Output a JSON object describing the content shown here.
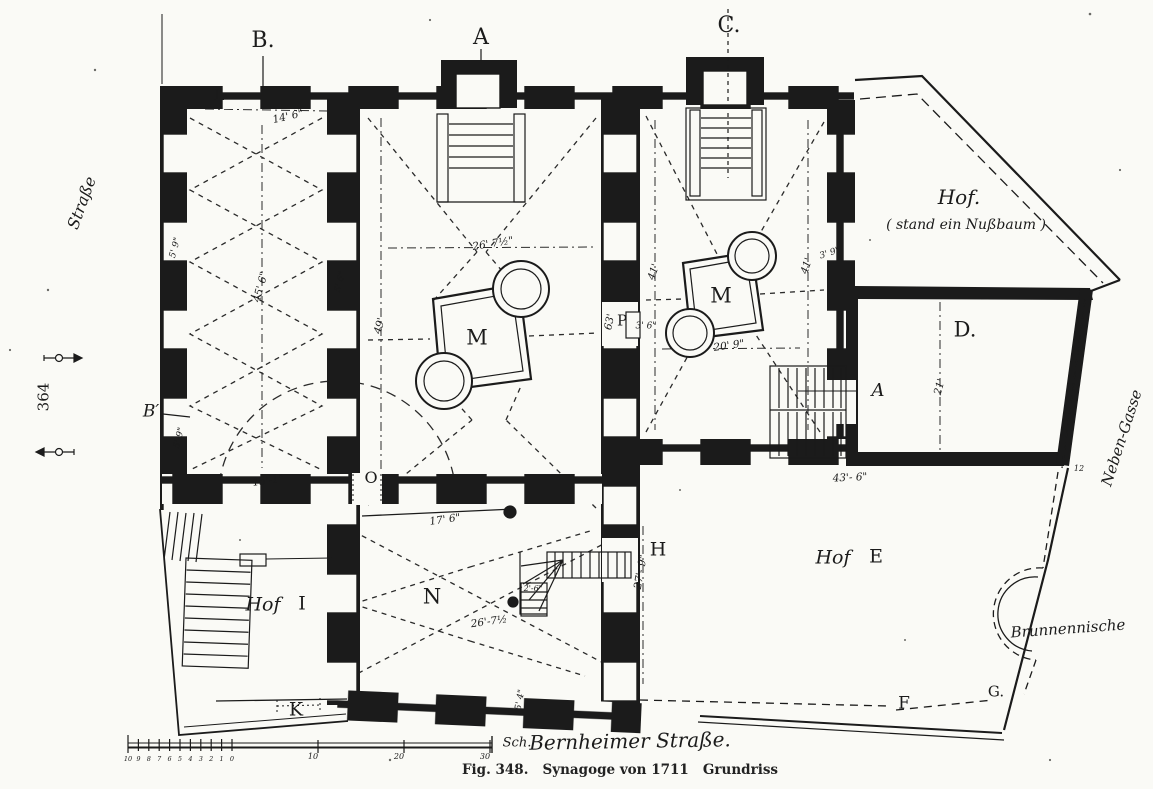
{
  "figure": {
    "caption": "Fig. 348.   Synagoge von 1711   Grundriss"
  },
  "colors": {
    "ink": "#1b1b1b",
    "paper": "#fafaf6"
  },
  "scale_bar": {
    "fine_tick_labels": [
      "10",
      "9",
      "8",
      "7",
      "6",
      "5",
      "4",
      "3",
      "2",
      "1",
      "0"
    ],
    "major_tick_labels": [
      "10",
      "20",
      "30"
    ],
    "unit_label": "Sch."
  },
  "labels": [
    {
      "id": "section-b",
      "t": "B.",
      "x": 263,
      "y": 41,
      "s": 22,
      "c": "letter"
    },
    {
      "id": "section-a",
      "t": "A",
      "x": 481,
      "y": 38,
      "s": 22,
      "c": "letter"
    },
    {
      "id": "section-c",
      "t": "C.",
      "x": 729,
      "y": 26,
      "s": 22,
      "c": "letter"
    },
    {
      "id": "room-l",
      "t": "L",
      "x": 219,
      "y": 95,
      "s": 16,
      "c": "letter"
    },
    {
      "id": "door-o",
      "t": "O",
      "x": 371,
      "y": 478,
      "s": 16,
      "c": "letter"
    },
    {
      "id": "room-n",
      "t": "N",
      "x": 432,
      "y": 597,
      "s": 21,
      "c": "letter"
    },
    {
      "id": "bimah-m-main",
      "t": "M",
      "x": 477,
      "y": 338,
      "s": 21,
      "c": "letter"
    },
    {
      "id": "bimah-m-right",
      "t": "M",
      "x": 721,
      "y": 296,
      "s": 21,
      "c": "letter"
    },
    {
      "id": "room-d",
      "t": "D.",
      "x": 965,
      "y": 330,
      "s": 21,
      "c": "letter"
    },
    {
      "id": "door-h",
      "t": "H",
      "x": 658,
      "y": 550,
      "s": 19,
      "c": "letter"
    },
    {
      "id": "door-k",
      "t": "K",
      "x": 296,
      "y": 710,
      "s": 19,
      "c": "letter"
    },
    {
      "id": "point-f",
      "t": "F",
      "x": 904,
      "y": 704,
      "s": 17,
      "c": "letter"
    },
    {
      "id": "point-g",
      "t": "G.",
      "x": 996,
      "y": 692,
      "s": 15,
      "c": "letter"
    },
    {
      "id": "pier-p",
      "t": "P",
      "x": 622,
      "y": 321,
      "s": 15,
      "c": "letter"
    },
    {
      "id": "section-b-prime",
      "t": "B′",
      "x": 151,
      "y": 412,
      "s": 17,
      "c": "script"
    },
    {
      "id": "hof-i-word",
      "t": "Hof",
      "x": 263,
      "y": 605,
      "s": 19,
      "c": "script"
    },
    {
      "id": "hof-i-letter",
      "t": "I",
      "x": 302,
      "y": 604,
      "s": 19,
      "c": "letter"
    },
    {
      "id": "hof-e-word",
      "t": "Hof",
      "x": 833,
      "y": 558,
      "s": 19,
      "c": "script"
    },
    {
      "id": "hof-e-letter",
      "t": "E",
      "x": 876,
      "y": 557,
      "s": 19,
      "c": "letter"
    },
    {
      "id": "hof-top",
      "t": "Hof.",
      "x": 959,
      "y": 197,
      "s": 20,
      "c": "script"
    },
    {
      "id": "hof-top-note",
      "t": "( stand ein Nußbaum )",
      "x": 966,
      "y": 225,
      "s": 14,
      "c": "script"
    },
    {
      "id": "stair-a-mark",
      "t": "A",
      "x": 878,
      "y": 391,
      "s": 18,
      "c": "script"
    },
    {
      "id": "niche-label",
      "t": "Brunnennische",
      "x": 1068,
      "y": 629,
      "r": -4,
      "s": 15,
      "c": "script"
    },
    {
      "id": "street-left",
      "t": "Straße",
      "x": 82,
      "y": 203,
      "r": -70,
      "s": 16,
      "c": "script"
    },
    {
      "id": "street-right",
      "t": "Neben-Gasse",
      "x": 1122,
      "y": 438,
      "r": -72,
      "s": 15,
      "c": "script"
    },
    {
      "id": "street-bottom",
      "t": "Bernheimer Straße.",
      "x": 630,
      "y": 741,
      "r": -1,
      "s": 20,
      "c": "script"
    },
    {
      "id": "scale-unit",
      "t": "Sch.",
      "x": 517,
      "y": 743,
      "s": 13,
      "c": "script"
    },
    {
      "id": "page-number",
      "t": "364",
      "x": 44,
      "y": 397,
      "r": -90,
      "s": 15,
      "c": "letter"
    },
    {
      "id": "dim-14-6",
      "t": "14' 6\"",
      "x": 288,
      "y": 117,
      "r": -13,
      "s": 10.5,
      "c": "dim"
    },
    {
      "id": "dim-45-6",
      "t": "45' 6\"",
      "x": 261,
      "y": 287,
      "r": -75,
      "s": 10.5,
      "c": "dim"
    },
    {
      "id": "dim-5-9-a",
      "t": "5' 9\"",
      "x": 176,
      "y": 248,
      "r": -75,
      "s": 9,
      "c": "dim"
    },
    {
      "id": "dim-5-9-b",
      "t": "5'-9\"",
      "x": 180,
      "y": 438,
      "r": -75,
      "s": 9,
      "c": "dim"
    },
    {
      "id": "dim-5-6",
      "t": "5' 6\"",
      "x": 341,
      "y": 282,
      "r": -75,
      "s": 9,
      "c": "dim"
    },
    {
      "id": "dim-49",
      "t": "49'",
      "x": 380,
      "y": 326,
      "r": -75,
      "s": 10.5,
      "c": "dim"
    },
    {
      "id": "dim-26-7-main",
      "t": "26' 7½\"",
      "x": 493,
      "y": 244,
      "r": -9,
      "s": 10.5,
      "c": "dim"
    },
    {
      "id": "dim-63",
      "t": "63'",
      "x": 610,
      "y": 322,
      "r": -78,
      "s": 10.5,
      "c": "dim"
    },
    {
      "id": "dim-3-6",
      "t": "3' 6\"",
      "x": 646,
      "y": 327,
      "r": 0,
      "s": 9,
      "c": "dim"
    },
    {
      "id": "dim-41-left",
      "t": "41'",
      "x": 654,
      "y": 272,
      "r": -72,
      "s": 10.5,
      "c": "dim"
    },
    {
      "id": "dim-41-right",
      "t": "41'",
      "x": 807,
      "y": 266,
      "r": -72,
      "s": 10.5,
      "c": "dim"
    },
    {
      "id": "dim-3-9",
      "t": "3' 9\"",
      "x": 830,
      "y": 254,
      "r": -18,
      "s": 9,
      "c": "dim"
    },
    {
      "id": "dim-20-9",
      "t": "20' 9\"",
      "x": 729,
      "y": 346,
      "r": -8,
      "s": 10.5,
      "c": "dim"
    },
    {
      "id": "dim-15-1",
      "t": "15'-1\"",
      "x": 268,
      "y": 481,
      "r": -8,
      "s": 10.5,
      "c": "dim"
    },
    {
      "id": "dim-17-6",
      "t": "17' 6\"",
      "x": 445,
      "y": 520,
      "r": -8,
      "s": 10.5,
      "c": "dim"
    },
    {
      "id": "dim-26-7-n",
      "t": "26'-7½",
      "x": 489,
      "y": 622,
      "r": -8,
      "s": 10.5,
      "c": "dim"
    },
    {
      "id": "dim-2-6",
      "t": "2'-6\"",
      "x": 533,
      "y": 589,
      "r": 0,
      "s": 8,
      "c": "dim"
    },
    {
      "id": "dim-27-9",
      "t": "27'- 9\"",
      "x": 641,
      "y": 572,
      "r": -80,
      "s": 10.5,
      "c": "dim"
    },
    {
      "id": "dim-5-4",
      "t": "5' 4\"",
      "x": 521,
      "y": 700,
      "r": -80,
      "s": 9,
      "c": "dim"
    },
    {
      "id": "dim-43-6",
      "t": "43'- 6\"",
      "x": 850,
      "y": 478,
      "r": -3,
      "s": 10.5,
      "c": "dim"
    },
    {
      "id": "dim-21",
      "t": "21'",
      "x": 940,
      "y": 387,
      "r": -75,
      "s": 10.5,
      "c": "dim"
    },
    {
      "id": "dim-12",
      "t": "12",
      "x": 1079,
      "y": 469,
      "r": 0,
      "s": 8,
      "c": "dim"
    }
  ]
}
